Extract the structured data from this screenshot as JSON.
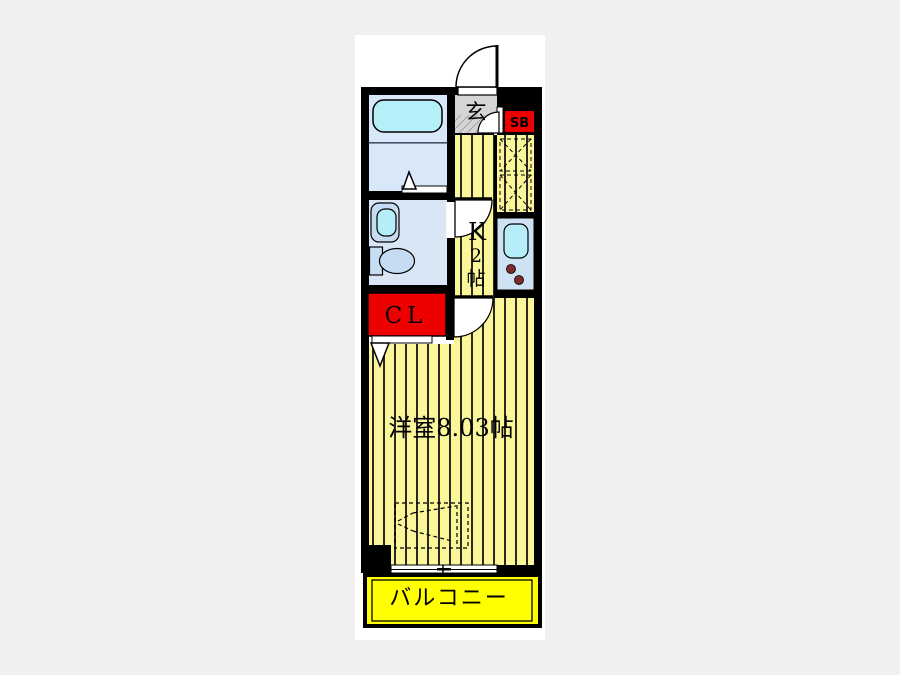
{
  "page": {
    "background_color": "#f0f0f0",
    "canvas_color": "#ffffff"
  },
  "floorplan": {
    "type": "apartment-floor-plan",
    "labels": {
      "entrance": "玄",
      "shoe_box": "SB",
      "kitchen_line1": "K",
      "kitchen_line2": "2",
      "kitchen_line3": "帖",
      "closet": "CL",
      "main_room": "洋室8.03帖",
      "balcony": "バルコニー"
    },
    "colors": {
      "wall": "#000000",
      "floor_stripe_yellow": "#fcf69b",
      "floor_stripe_line": "#2a2a22",
      "balcony_yellow": "#ffff00",
      "closet_red": "#ee0000",
      "shoebox_red": "#ee0000",
      "bathroom_blue": "#d9e8f8",
      "washroom_blue": "#d9e6f6",
      "fixture_blue": "#c6dcf2",
      "counter_blue": "#cfe2f4",
      "water_cyan": "#b5eef8",
      "tub_cyan": "#b5f0f9",
      "genkan_gray": "#d5d5d5",
      "burner_maroon": "#7c2a2a",
      "label_dark": "#1a1a1a",
      "sb_text": "#3d0f0f",
      "cl_text": "#3a3a3a"
    }
  }
}
